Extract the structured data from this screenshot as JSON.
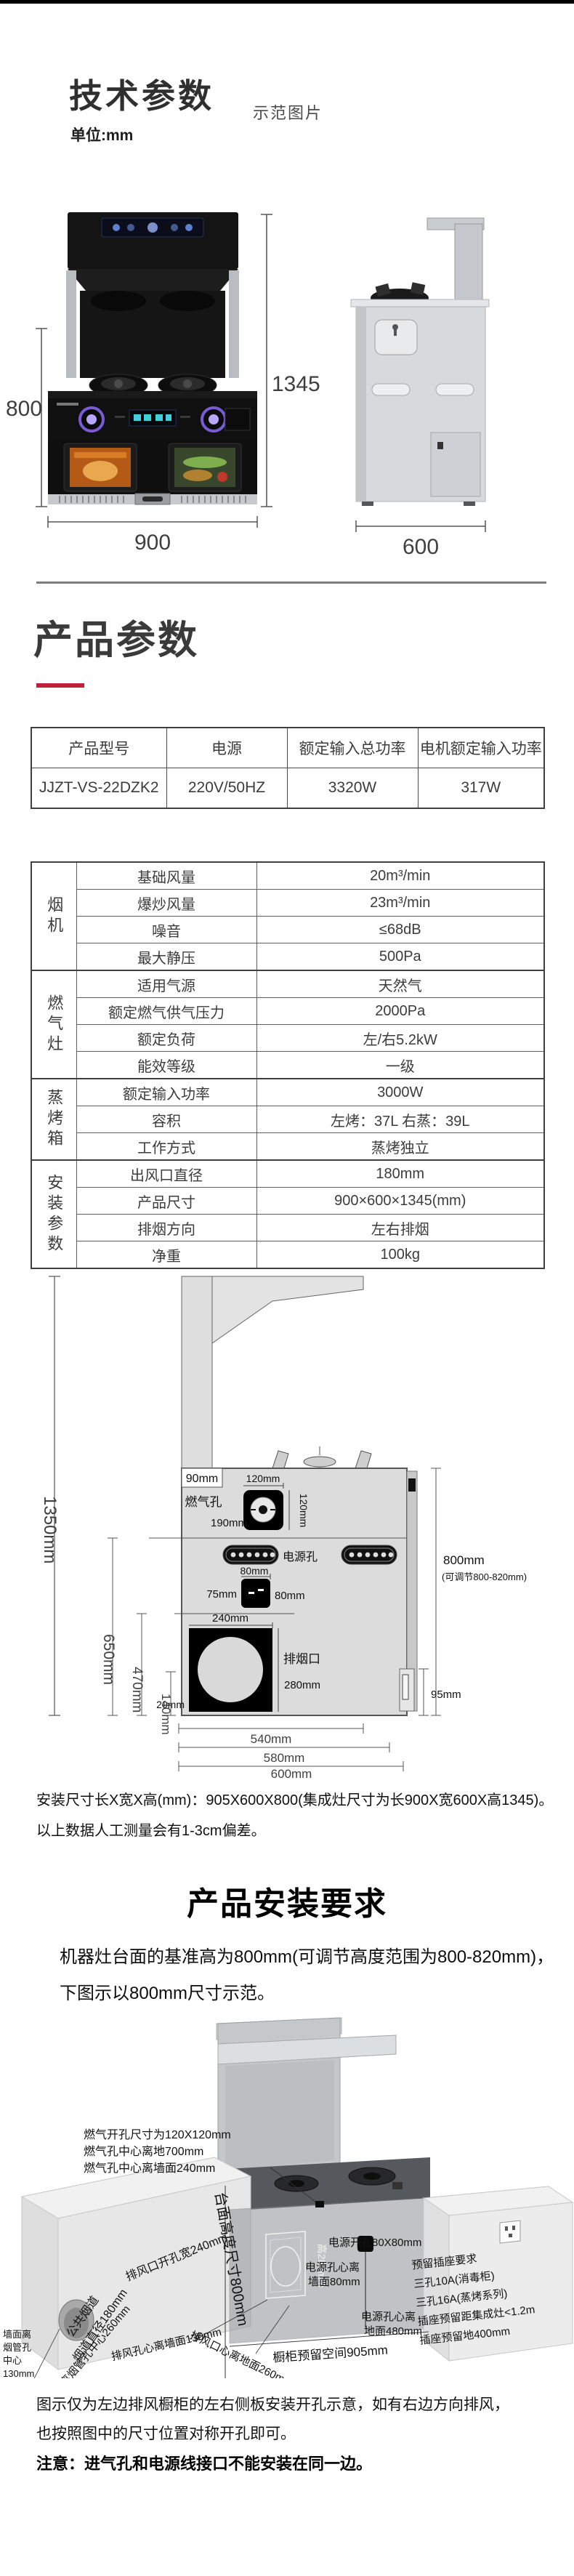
{
  "header": {
    "title": "技术参数",
    "subtitle": "示范图片",
    "unit": "单位:mm"
  },
  "photos": {
    "dim_total_height": "1345",
    "dim_cabinet_height": "800",
    "dim_width": "900",
    "dim_depth": "600"
  },
  "section_params": {
    "title": "产品参数"
  },
  "main_table": {
    "headers": [
      "产品型号",
      "电源",
      "额定输入总功率",
      "电机额定输入功率"
    ],
    "row": [
      "JJZT-VS-22DZK2",
      "220V/50HZ",
      "3320W",
      "317W"
    ]
  },
  "detail_table": {
    "groups": [
      {
        "category": "烟机",
        "rows": [
          {
            "label": "基础风量",
            "value": "20m³/min"
          },
          {
            "label": "爆炒风量",
            "value": "23m³/min"
          },
          {
            "label": "噪音",
            "value": "≤68dB"
          },
          {
            "label": "最大静压",
            "value": "500Pa"
          }
        ]
      },
      {
        "category": "燃气灶",
        "rows": [
          {
            "label": "适用气源",
            "value": "天然气"
          },
          {
            "label": "额定燃气供气压力",
            "value": "2000Pa"
          },
          {
            "label": "额定负荷",
            "value": "左/右5.2kW"
          },
          {
            "label": "能效等级",
            "value": "一级"
          }
        ]
      },
      {
        "category": "蒸烤箱",
        "rows": [
          {
            "label": "额定输入功率",
            "value": "3000W"
          },
          {
            "label": "容积",
            "value": "左烤：37L 右蒸：39L"
          },
          {
            "label": "工作方式",
            "value": "蒸烤独立"
          }
        ]
      },
      {
        "category": "安装参数",
        "rows": [
          {
            "label": "出风口直径",
            "value": "180mm"
          },
          {
            "label": "产品尺寸",
            "value": "900×600×1345(mm)"
          },
          {
            "label": "排烟方向",
            "value": "左右排烟"
          },
          {
            "label": "净重",
            "value": "100kg"
          }
        ]
      }
    ]
  },
  "drawing": {
    "total_height": "1350mm",
    "dim_650": "650mm",
    "dim_470": "470mm",
    "dim_140": "140mm",
    "dim_90": "90mm",
    "gas_hole_label": "燃气孔",
    "gas_width": "120mm",
    "gas_from_left": "190mm",
    "gas_height": "120mm",
    "power_hole_label": "电源孔",
    "power_top": "80mm",
    "power_left": "75mm",
    "power_right": "80mm",
    "exhaust_label": "排烟口",
    "exhaust_width": "240mm",
    "exhaust_height": "280mm",
    "exhaust_offset": "20mm",
    "counter_height": "800mm",
    "counter_height_note": "(可调节800-820mm)",
    "dim_95": "95mm",
    "dim_540": "540mm",
    "dim_580": "580mm",
    "dim_600": "600mm",
    "note1": "安装尺寸长X宽X高(mm)：905X600X800(集成灶尺寸为长900X宽600X高1345)。",
    "note2": "以上数据人工测量会有1-3cm偏差。"
  },
  "install": {
    "title": "产品安装要求",
    "para1": "机器灶台面的基准高为800mm(可调节高度范围为800-820mm)，",
    "para2": "下图示以800mm尺寸示范。"
  },
  "diagram": {
    "gas_note1": "燃气开孔尺寸为120X120mm",
    "gas_note2": "燃气孔中心离地700mm",
    "gas_note3": "燃气孔中心离墙面240mm",
    "flue1": "公共烟道",
    "flue2": "烟道直径180mm",
    "wall_flue": [
      "墙面离",
      "烟管孔",
      "中心",
      "130mm"
    ],
    "floor_flue": "地面离烟管孔中心260mm",
    "counter_h": "台面高度尺寸800mm",
    "vent_w": "排风口开孔宽240mm",
    "vent_h": "高280mm",
    "vent_wall": "排风孔心离墙面130mm",
    "vent_floor": "排风口心离地面260mm",
    "power_open": "电源开孔80X80mm",
    "power_wall1": "电源孔心离",
    "power_wall2": "墙面80mm",
    "power_floor1": "电源孔心离",
    "power_floor2": "地面480mm",
    "cabinet_space": "橱柜预留空间905mm",
    "socket1": "预留插座要求",
    "socket2": "三孔10A(消毒柜)",
    "socket3": "三孔16A(蒸烤系列)",
    "socket4": "插座预留距集成灶<1.2m",
    "socket5": "插座预留地400mm"
  },
  "footer": {
    "note1": "图示仅为左边排风橱柜的左右侧板安装开孔示意，如有右边方向排风，",
    "note2": "也按照图中的尺寸位置对称开孔即可。",
    "warning": "注意：进气孔和电源线接口不能安装在同一边。"
  }
}
